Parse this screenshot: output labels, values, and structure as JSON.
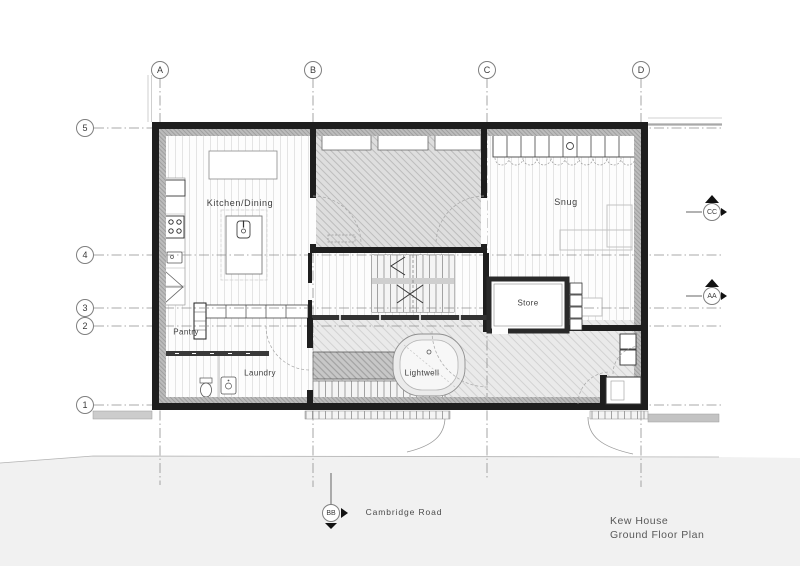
{
  "title": {
    "project": "Kew House",
    "drawing": "Ground Floor Plan"
  },
  "road": {
    "label": "Cambridge Road"
  },
  "rooms": {
    "kitchen_dining": "Kitchen/Dining",
    "snug": "Snug",
    "store": "Store",
    "pantry": "Pantry",
    "laundry": "Laundry",
    "lightwell": "Lightwell"
  },
  "grid": {
    "columns": [
      "A",
      "B",
      "C",
      "D"
    ],
    "rows": [
      "5",
      "4",
      "3",
      "2",
      "1"
    ]
  },
  "section_markers": {
    "cc": "CC",
    "aa": "AA",
    "bb": "BB"
  },
  "colors": {
    "wall": "#1e1e1e",
    "hatch_room": "#dedede",
    "hatch_court": "#e9e9e9",
    "hatch_dark": "#c7c7c7",
    "road": "#f1f1f1",
    "gridline": "#8f8f8f"
  }
}
